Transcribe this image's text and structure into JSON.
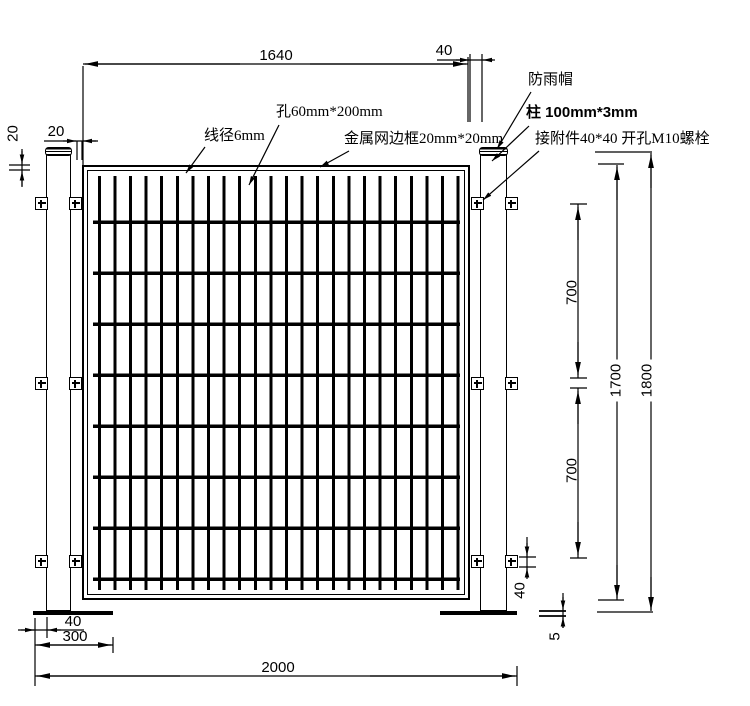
{
  "labels": {
    "wire_diameter": "线径6mm",
    "mesh_hole": "孔60mm*200mm",
    "mesh_frame": "金属网边框20mm*20mm",
    "rain_cap": "防雨帽",
    "post_spec": "柱 100mm*3mm",
    "attachment": "接附件40*40 开孔M10螺栓"
  },
  "dimensions": {
    "panel_width": "1640",
    "panel_post_gap": "40",
    "post_mesh_gap": "20",
    "frame_edge": "20",
    "clip_spacing_upper": "700",
    "clip_spacing_lower": "700",
    "mesh_height": "1700",
    "post_height": "1800",
    "clip_height": "40",
    "base_plate_thickness": "5",
    "overall_width": "2000",
    "base_plate_width": "300",
    "plate_edge_offset": "40"
  }
}
